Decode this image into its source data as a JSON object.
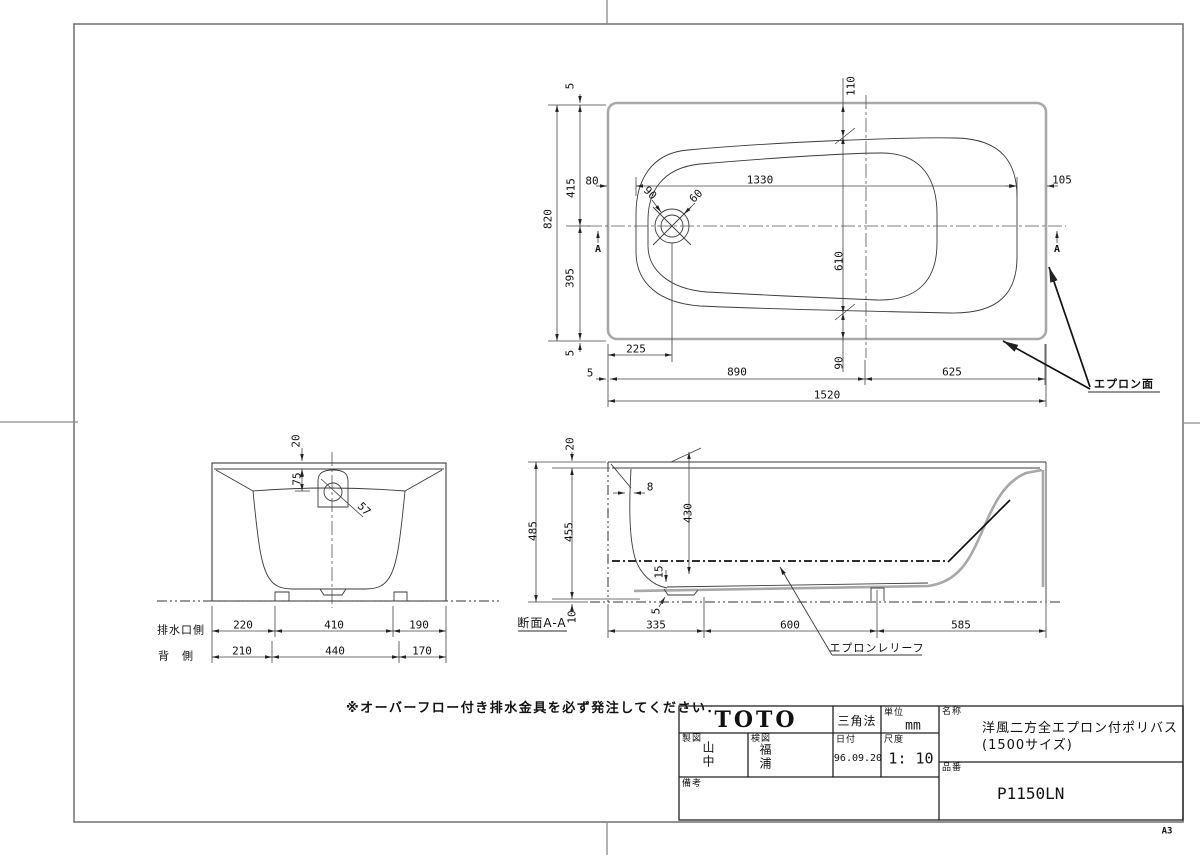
{
  "sheet": {
    "size": "A3"
  },
  "note": "※オーバーフロー付き排水金具を必ず発注してください．",
  "plan": {
    "apron_label": "エプロン面",
    "marker_a_left": "A",
    "marker_a_right": "A",
    "d5_top": "5",
    "d415": "415",
    "d820": "820",
    "d395": "395",
    "d5_bottom": "5",
    "d80": "80",
    "d1330": "1330",
    "d105": "105",
    "d110": "110",
    "d610": "610",
    "d90_chain": "90",
    "d90_drain": "90",
    "d60_drain": "60",
    "d225": "225",
    "d5_edge": "5",
    "d890": "890",
    "d625": "625",
    "d1520": "1520"
  },
  "end_view": {
    "d20": "20",
    "d75": "75",
    "d57": "57",
    "row1_label": "排水口側",
    "row1": [
      "220",
      "410",
      "190"
    ],
    "row2_label": "背　側",
    "row2": [
      "210",
      "440",
      "170"
    ]
  },
  "section": {
    "title": "断面A-A",
    "apron_relief": "エプロンレリーフ",
    "d20": "20",
    "d485": "485",
    "d455": "455",
    "d10": "10",
    "d8": "8",
    "d430": "430",
    "d15": "15",
    "d5": "5",
    "d335": "335",
    "d600": "600",
    "d585": "585"
  },
  "title_block": {
    "logo": "TOTO",
    "projection": "三角法",
    "unit_label": "単位",
    "unit": "mm",
    "date_label": "日付",
    "date": "96.09.20",
    "scale_label": "尺度",
    "scale": "1: 10",
    "drafter_label": "製図",
    "drafter": "山中",
    "checker_label": "検図",
    "checker": "福浦",
    "remarks_label": "備考",
    "name_label": "名称",
    "name_line1": "洋風二方全エプロン付ポリバス",
    "name_line2": "(1500サイズ)",
    "part_label": "品番",
    "part_no": "P1150LN"
  }
}
